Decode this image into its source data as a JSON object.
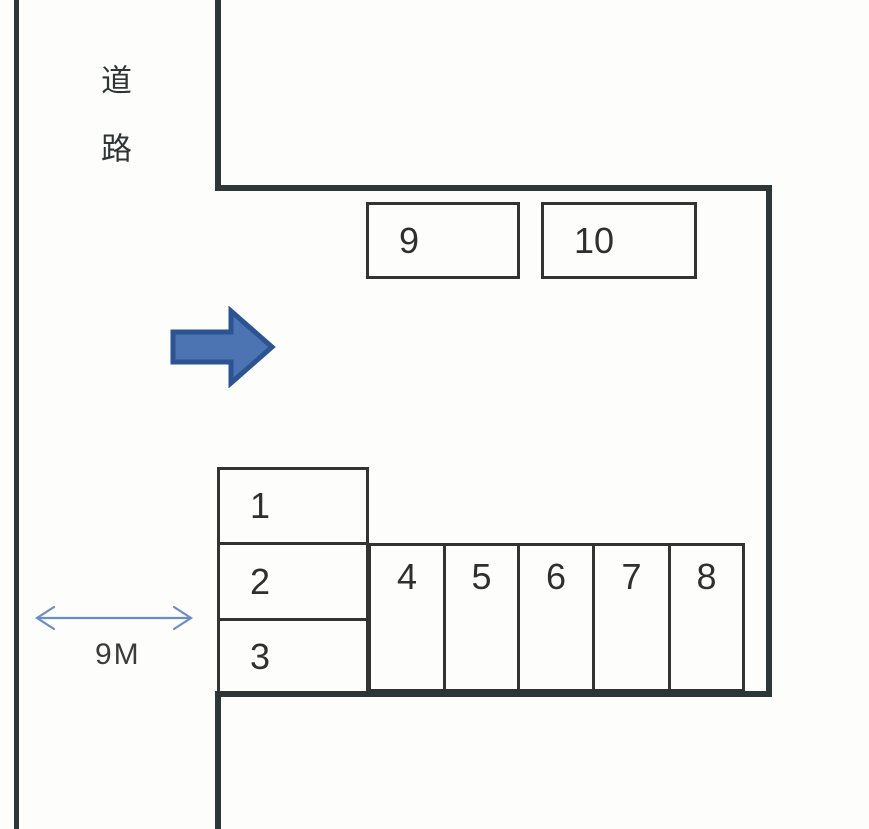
{
  "labels": {
    "road": "道路",
    "dimension": "9M"
  },
  "spaces": [
    "1",
    "2",
    "3",
    "4",
    "5",
    "6",
    "7",
    "8",
    "9",
    "10"
  ],
  "colors": {
    "arrow_fill": "#4d74b2",
    "arrow_stroke": "#2c5492",
    "dimension_arrow": "#6a8cc7",
    "boundary_line": "#2e3737",
    "space_border": "#333333",
    "text": "#2f2f2f",
    "background": "#fdfdfc"
  }
}
